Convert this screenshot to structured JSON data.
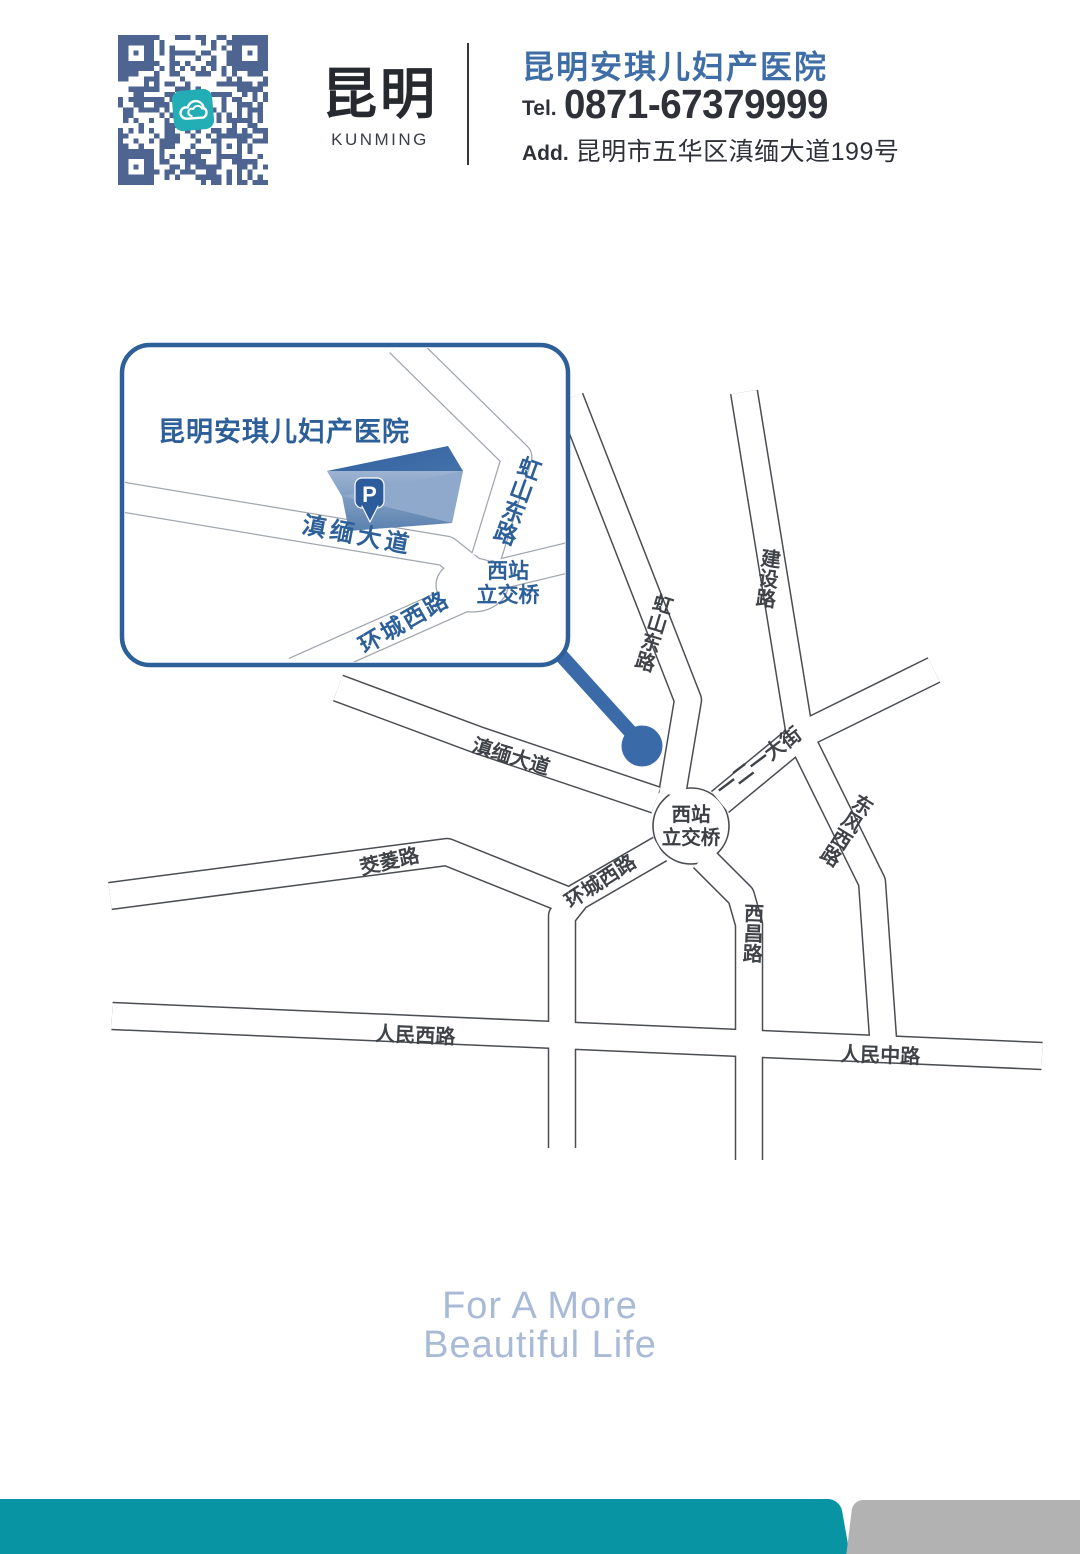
{
  "header": {
    "qr": {
      "icon": "cloud-icon"
    },
    "city_cn": "昆明",
    "city_en": "KUNMING",
    "hospital_name": "昆明安琪儿妇产医院",
    "tel_label": "Tel.",
    "tel_number": "0871-67379999",
    "addr_label": "Add.",
    "address": "昆明市五华区滇缅大道199号"
  },
  "inset_map": {
    "title": "昆明安琪儿妇产医院",
    "parking_label": "P",
    "junction": {
      "line1": "西站",
      "line2": "立交桥"
    },
    "roads": {
      "dianmian_avenue": "滇缅大道",
      "hongshan_east_road": "虹山东路",
      "huancheng_west_road": "环城西路"
    }
  },
  "main_map": {
    "junction": {
      "line1": "西站",
      "line2": "立交桥"
    },
    "roads": {
      "jianshe_road": "建设路",
      "hongshan_east_road": "虹山东路",
      "dianmian_avenue": "滇缅大道",
      "yieryi_street": "一二一大街",
      "dongfeng_west_road": "东风西路",
      "xichang_road": "西昌路",
      "huancheng_west_road": "环城西路",
      "jiaoling_road": "茭菱路",
      "renmin_west_road": "人民西路",
      "renmin_middle_road": "人民中路"
    }
  },
  "footer": {
    "slogan_line1": "For A More",
    "slogan_line2": "Beautiful Life"
  },
  "colors": {
    "brand-blue": "#3f6ea6",
    "map-blue": "#2d5f98",
    "marker-blue": "#3a6aa8",
    "qr-slate": "#4d6590",
    "icon-teal": "#23adb4",
    "bar-teal": "#0994a4",
    "bar-gray": "#b2b2b2",
    "slogan-blue": "#a9bad7",
    "ink-dark": "#2e3238"
  }
}
